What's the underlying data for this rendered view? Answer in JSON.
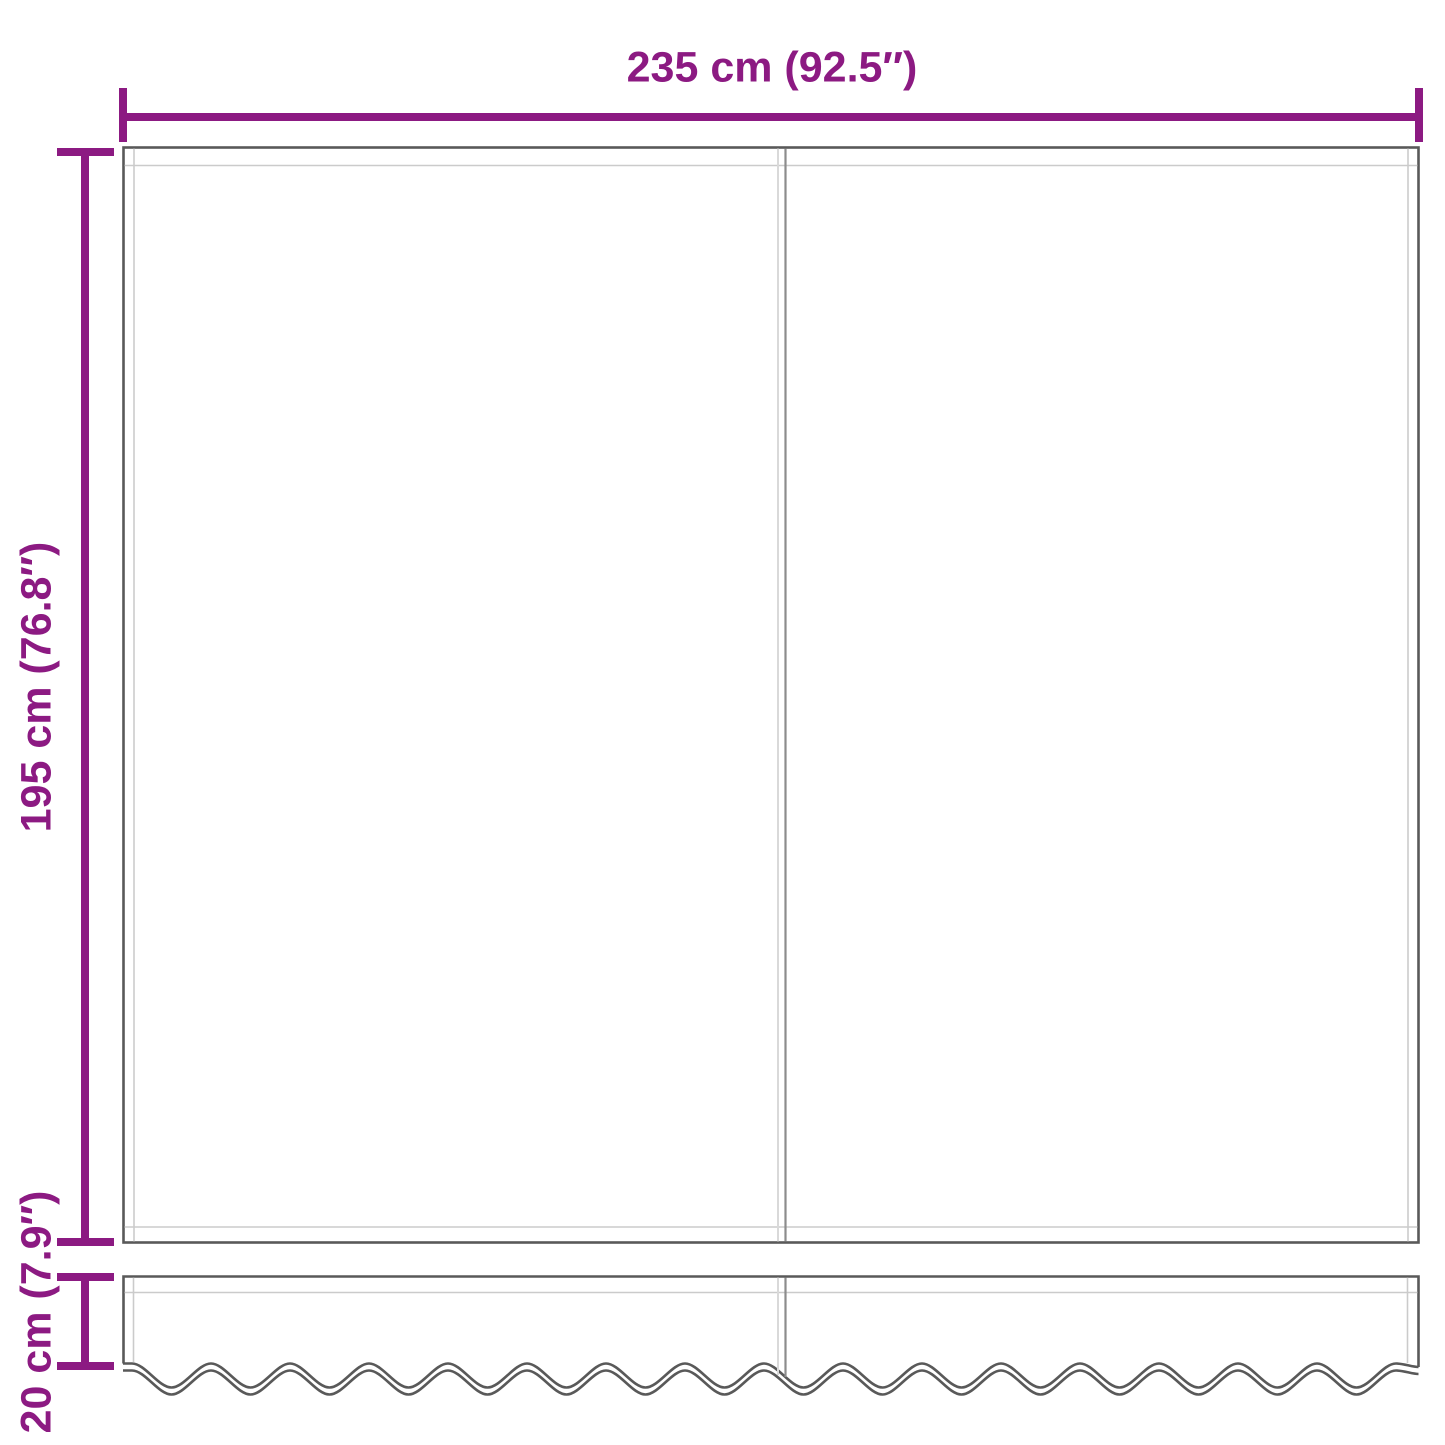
{
  "diagram": {
    "labels": {
      "width": "235 cm (92.5″)",
      "height": "195 cm (76.8″)",
      "valance_height": "20 cm (7.9″)"
    },
    "colors": {
      "dimension": "#8C1A82",
      "outline_dark": "#595959",
      "outline_light": "#cbcbcb",
      "seam_dark": "#8c8c8c",
      "seam_light": "#d9d9d9",
      "background": "#ffffff"
    }
  }
}
